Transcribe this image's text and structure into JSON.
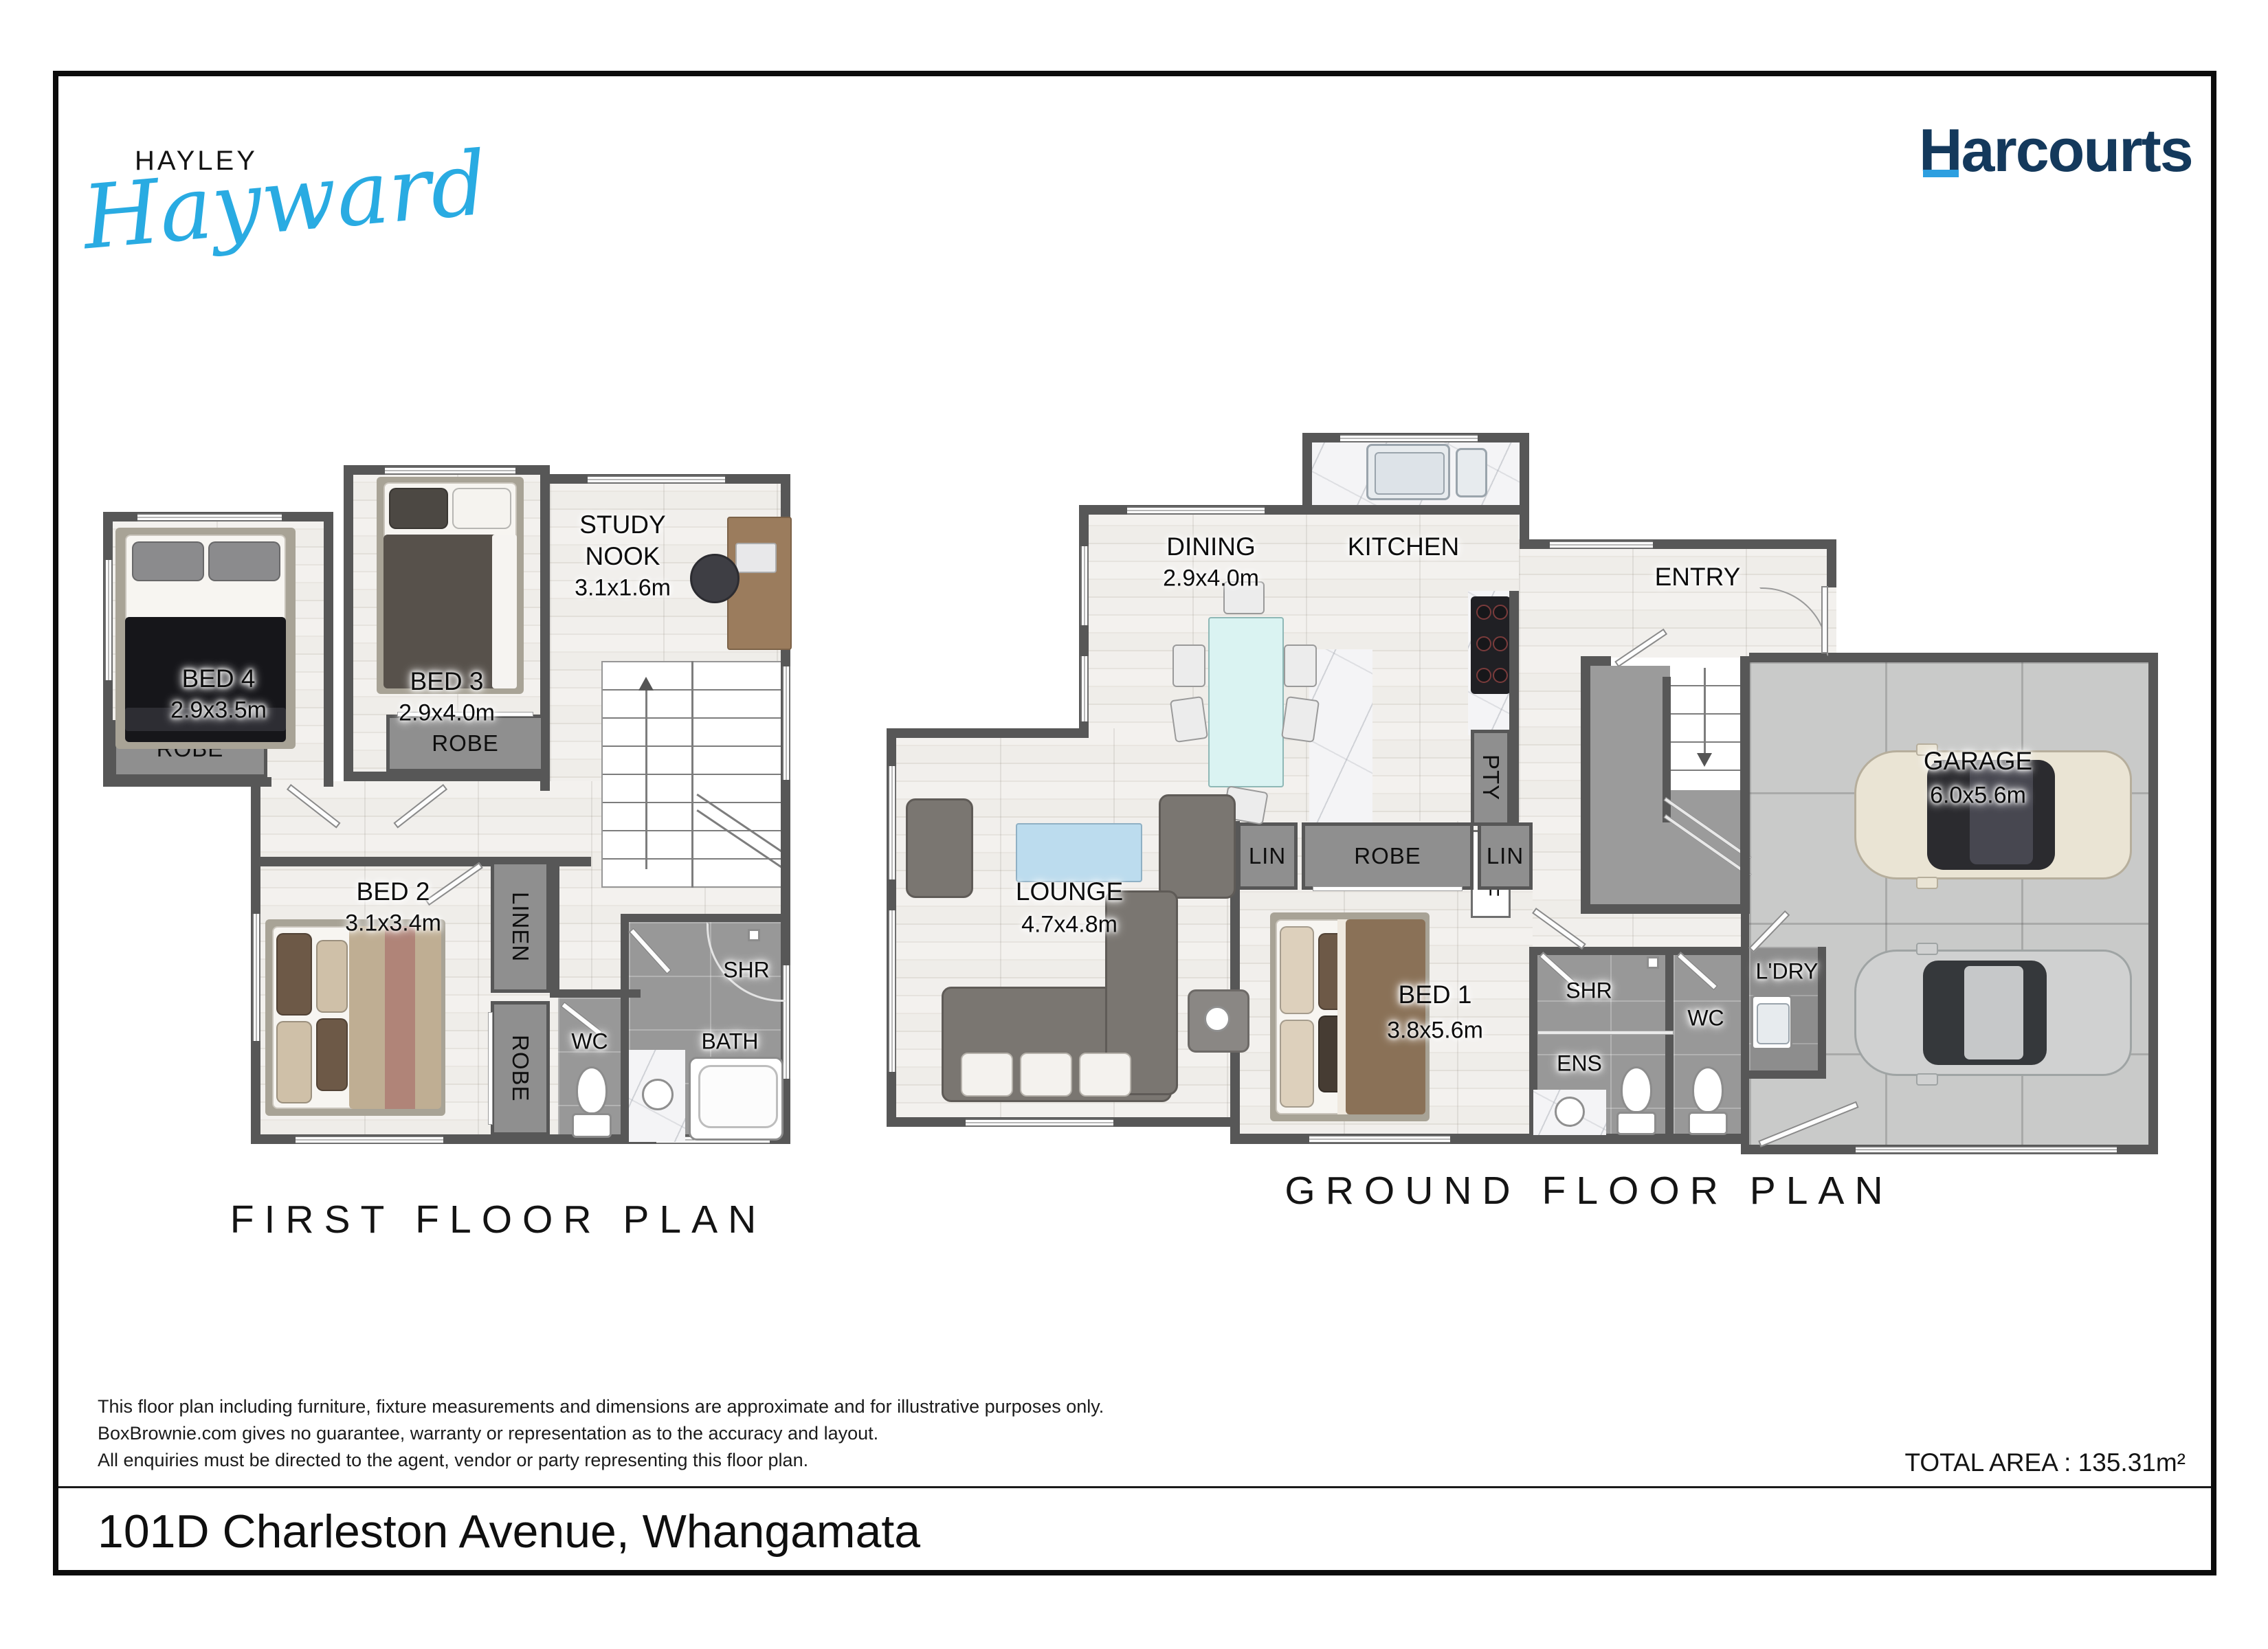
{
  "brand": {
    "agent_first": "HAYLEY",
    "agent_last": "Hayward",
    "company": "Harcourts"
  },
  "colors": {
    "accent_blue": "#29abe2",
    "company_navy": "#14395c",
    "wall_gray": "#575757"
  },
  "first_floor": {
    "title": "FIRST FLOOR PLAN",
    "rooms": {
      "bed4": {
        "name": "BED 4",
        "dims": "2.9x3.5m"
      },
      "bed3": {
        "name": "BED 3",
        "dims": "2.9x4.0m"
      },
      "study_nook": {
        "line1": "STUDY",
        "line2": "NOOK",
        "dims": "3.1x1.6m"
      },
      "bed2": {
        "name": "BED 2",
        "dims": "3.1x3.4m"
      },
      "robe_bed4": "ROBE",
      "robe_bed3": "ROBE",
      "linen": "LINEN",
      "robe_bed2": "ROBE",
      "wc": "WC",
      "bath": "BATH",
      "shr": "SHR"
    }
  },
  "ground_floor": {
    "title": "GROUND FLOOR PLAN",
    "rooms": {
      "dining": {
        "name": "DINING",
        "dims": "2.9x4.0m"
      },
      "kitchen": {
        "name": "KITCHEN"
      },
      "entry": {
        "name": "ENTRY"
      },
      "pty": "PTY",
      "ref": "REF",
      "garage": {
        "name": "GARAGE",
        "dims": "6.0x5.6m"
      },
      "lounge": {
        "name": "LOUNGE",
        "dims": "4.7x4.8m"
      },
      "lin_left": "LIN",
      "robe": "ROBE",
      "lin_right": "LIN",
      "bed1": {
        "name": "BED 1",
        "dims": "3.8x5.6m"
      },
      "shr": "SHR",
      "ens": "ENS",
      "wc": "WC",
      "ldry": "L'DRY"
    }
  },
  "footer": {
    "disclaimer_line1": "This floor plan including furniture, fixture measurements and dimensions are approximate and for illustrative purposes only.",
    "disclaimer_line2": "BoxBrownie.com gives no guarantee, warranty or representation as to the accuracy and layout.",
    "disclaimer_line3": "All enquiries must be directed to the agent, vendor or party representing this floor plan.",
    "total_area": "TOTAL AREA : 135.31m²",
    "address": "101D Charleston Avenue, Whangamata"
  }
}
